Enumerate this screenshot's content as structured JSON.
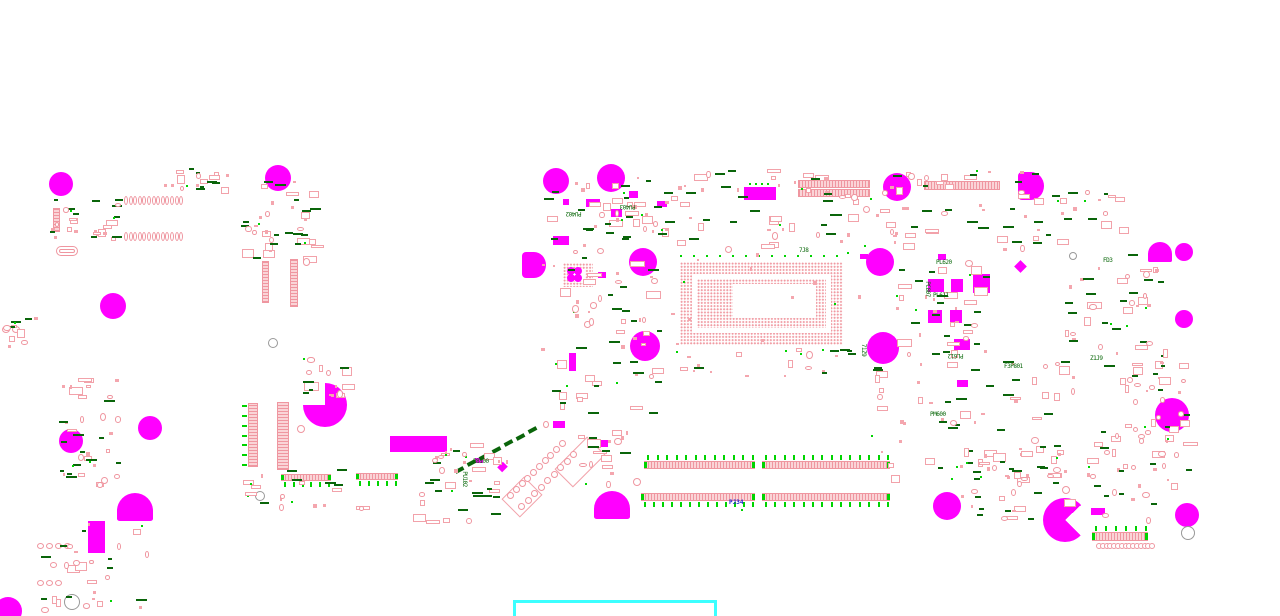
{
  "diagram": {
    "type": "pcb-component-placement-drawing",
    "board_size": [
      1280,
      616
    ],
    "colors": {
      "background": "#ffffff",
      "mounting_hole": "#ff00ff",
      "pad_outline": "#ef96a0",
      "pad_fill": "#fad4d7",
      "designator_green": "#076607",
      "tick_green": "#00d400",
      "designator_blue": "#2222cc",
      "selection_cyan": "#3cffff"
    },
    "labels": [
      [
        "PU402",
        566,
        210,
        180,
        "g"
      ],
      [
        "PU403",
        620,
        203,
        180,
        "g"
      ],
      [
        "PU102",
        456,
        476,
        90,
        "g"
      ],
      [
        "P8100",
        473,
        459,
        0,
        "g"
      ],
      [
        "PL611",
        933,
        293,
        0,
        "g"
      ],
      [
        "PC807",
        919,
        286,
        90,
        "g"
      ],
      [
        "PL612",
        948,
        352,
        180,
        "g"
      ],
      [
        "F3P801",
        1004,
        364,
        0,
        "g"
      ],
      [
        "PM600",
        930,
        412,
        0,
        "g"
      ],
      [
        "FD3",
        1103,
        258,
        0,
        "g"
      ],
      [
        "71Z9",
        857,
        347,
        90,
        "g"
      ],
      [
        "PL620",
        936,
        260,
        0,
        "g"
      ],
      [
        "7J8",
        799,
        248,
        0,
        "g"
      ],
      [
        "Z1J9",
        1090,
        356,
        0,
        "g"
      ],
      [
        "PJ34",
        729,
        500,
        0,
        "b"
      ]
    ],
    "holes": [
      [
        61,
        184,
        12,
        "c"
      ],
      [
        278,
        178,
        13,
        "c"
      ],
      [
        113,
        306,
        13,
        "c"
      ],
      [
        556,
        181,
        13,
        "c"
      ],
      [
        611,
        178,
        14,
        "c"
      ],
      [
        897,
        187,
        14,
        "c"
      ],
      [
        1030,
        186,
        14,
        "dl"
      ],
      [
        643,
        262,
        14,
        "c"
      ],
      [
        880,
        262,
        14,
        "c"
      ],
      [
        533,
        265,
        13,
        "dl"
      ],
      [
        1160,
        252,
        12,
        "db"
      ],
      [
        1184,
        252,
        9,
        "c"
      ],
      [
        1184,
        319,
        9,
        "c"
      ],
      [
        645,
        346,
        15,
        "c"
      ],
      [
        883,
        348,
        16,
        "c"
      ],
      [
        1172,
        415,
        17,
        "c"
      ],
      [
        150,
        428,
        12,
        "c"
      ],
      [
        71,
        441,
        12,
        "c"
      ],
      [
        325,
        405,
        22,
        "p1"
      ],
      [
        135,
        507,
        18,
        "db"
      ],
      [
        612,
        505,
        18,
        "db"
      ],
      [
        947,
        506,
        14,
        "c"
      ],
      [
        1187,
        515,
        12,
        "c"
      ],
      [
        1065,
        520,
        22,
        "p2"
      ],
      [
        8,
        611,
        14,
        "c"
      ]
    ],
    "solid_rects": [
      [
        390,
        436,
        57,
        16,
        0
      ],
      [
        88,
        521,
        17,
        32,
        0
      ],
      [
        744,
        187,
        32,
        13,
        0
      ],
      [
        563,
        199,
        6,
        6,
        0
      ],
      [
        586,
        199,
        14,
        8,
        0
      ],
      [
        611,
        209,
        11,
        8,
        0
      ],
      [
        629,
        191,
        9,
        7,
        0
      ],
      [
        657,
        201,
        10,
        6,
        0
      ],
      [
        553,
        236,
        16,
        9,
        0
      ],
      [
        598,
        272,
        8,
        6,
        0
      ],
      [
        569,
        353,
        7,
        18,
        0
      ],
      [
        938,
        254,
        8,
        6,
        0
      ],
      [
        928,
        279,
        16,
        13,
        0
      ],
      [
        951,
        279,
        12,
        13,
        0
      ],
      [
        928,
        310,
        14,
        13,
        0
      ],
      [
        950,
        310,
        12,
        13,
        0
      ],
      [
        973,
        274,
        17,
        19,
        0
      ],
      [
        954,
        339,
        16,
        11,
        0
      ],
      [
        957,
        380,
        11,
        7,
        0
      ],
      [
        1016,
        262,
        9,
        9,
        45
      ],
      [
        1091,
        508,
        14,
        7,
        0
      ],
      [
        860,
        254,
        8,
        5,
        0
      ],
      [
        475,
        458,
        8,
        5,
        0
      ],
      [
        499,
        463,
        7,
        8,
        45
      ],
      [
        601,
        440,
        7,
        7,
        0
      ],
      [
        553,
        421,
        12,
        7,
        0
      ]
    ],
    "green_dots": [
      [
        749,
        183
      ],
      [
        755,
        183
      ],
      [
        761,
        183
      ],
      [
        767,
        183
      ],
      [
        741,
        509
      ],
      [
        247,
        495
      ]
    ],
    "connectors": [
      [
        644,
        461,
        111,
        8,
        "h",
        "a"
      ],
      [
        762,
        461,
        128,
        8,
        "h",
        "a"
      ],
      [
        641,
        493,
        114,
        8,
        "h",
        "b"
      ],
      [
        762,
        493,
        128,
        8,
        "h",
        "b"
      ],
      [
        924,
        181,
        76,
        9,
        "h",
        ""
      ],
      [
        798,
        180,
        72,
        8,
        "h",
        ""
      ],
      [
        798,
        189,
        72,
        8,
        "h",
        ""
      ],
      [
        281,
        474,
        50,
        7,
        "h",
        "b"
      ],
      [
        356,
        473,
        42,
        7,
        "h",
        "b"
      ],
      [
        1092,
        532,
        56,
        9,
        "h",
        "a"
      ],
      [
        262,
        261,
        7,
        42,
        "v",
        ""
      ],
      [
        290,
        259,
        8,
        48,
        "v",
        ""
      ],
      [
        248,
        403,
        10,
        64,
        "v",
        "l"
      ],
      [
        277,
        402,
        12,
        68,
        "v",
        ""
      ],
      [
        53,
        208,
        7,
        24,
        "v",
        ""
      ]
    ],
    "oval_rows": [
      [
        124,
        196,
        13,
        4.6,
        4,
        9
      ],
      [
        124,
        232,
        13,
        4.6,
        4,
        9
      ],
      [
        37,
        543,
        4,
        9,
        7,
        6
      ],
      [
        37,
        580,
        3,
        9,
        7,
        6
      ],
      [
        2,
        326,
        2,
        10,
        8,
        7
      ]
    ],
    "circ_rows": [
      [
        1096,
        543,
        15,
        3.8,
        6
      ]
    ],
    "rings": [
      [
        1073,
        256,
        4,
        "g"
      ],
      [
        1188,
        533,
        7,
        "g"
      ],
      [
        72,
        602,
        8,
        "g"
      ],
      [
        273,
        343,
        5,
        "g"
      ],
      [
        260,
        496,
        5,
        "g"
      ],
      [
        301,
        429,
        4,
        "p"
      ],
      [
        637,
        482,
        4,
        "p"
      ]
    ],
    "stadiums": [
      [
        56,
        246,
        22,
        10
      ]
    ],
    "cpu_bga": {
      "x": 680,
      "y": 262,
      "w": 163,
      "h": 83,
      "band": 12,
      "inner_pad": 17,
      "die": [
        733,
        284,
        83,
        34
      ],
      "perim_dot_step": 13
    },
    "qfn": {
      "x": 563,
      "y": 263,
      "w": 30,
      "h": 24,
      "center": [
        571,
        269,
        14,
        12
      ],
      "blobs": [
        [
          571,
          271
        ],
        [
          578,
          271
        ],
        [
          571,
          278
        ],
        [
          578,
          278
        ]
      ]
    },
    "diag_group": {
      "outlines": [
        [
          580,
          462,
          46,
          26
        ],
        [
          522,
          497,
          32,
          26
        ]
      ],
      "ring_lines": [
        [
          510,
          495,
          562,
          443,
          10
        ],
        [
          521,
          506,
          573,
          454,
          9
        ]
      ],
      "green_line": [
        455,
        468,
        528,
        428,
        7
      ]
    },
    "selection_box": [
      513,
      600,
      204,
      30
    ],
    "clusters": [
      [
        50,
        198,
        70,
        42,
        6,
        8,
        10,
        2,
        3,
        1
      ],
      [
        160,
        168,
        70,
        20,
        4,
        6,
        6,
        1,
        2,
        2
      ],
      [
        238,
        178,
        75,
        85,
        8,
        12,
        14,
        2,
        6,
        3
      ],
      [
        300,
        352,
        45,
        42,
        3,
        5,
        5,
        1,
        4,
        4
      ],
      [
        58,
        375,
        60,
        110,
        8,
        10,
        12,
        2,
        8,
        5
      ],
      [
        35,
        520,
        110,
        90,
        5,
        7,
        8,
        2,
        10,
        6
      ],
      [
        408,
        440,
        100,
        80,
        8,
        12,
        12,
        3,
        6,
        7
      ],
      [
        540,
        175,
        140,
        75,
        12,
        16,
        18,
        4,
        6,
        8
      ],
      [
        540,
        255,
        120,
        170,
        12,
        18,
        20,
        4,
        10,
        9
      ],
      [
        680,
        168,
        180,
        85,
        12,
        16,
        16,
        3,
        6,
        10
      ],
      [
        862,
        168,
        200,
        80,
        14,
        18,
        18,
        4,
        8,
        11
      ],
      [
        862,
        360,
        200,
        120,
        14,
        20,
        20,
        3,
        8,
        12
      ],
      [
        1062,
        250,
        100,
        140,
        10,
        14,
        16,
        3,
        10,
        13
      ],
      [
        955,
        440,
        110,
        80,
        10,
        14,
        14,
        3,
        6,
        14
      ],
      [
        1085,
        420,
        90,
        110,
        6,
        10,
        8,
        2,
        10,
        15
      ],
      [
        660,
        345,
        200,
        40,
        6,
        4,
        6,
        2,
        2,
        16
      ],
      [
        1130,
        330,
        60,
        140,
        4,
        6,
        6,
        1,
        12,
        17
      ],
      [
        895,
        255,
        90,
        100,
        8,
        12,
        14,
        3,
        4,
        18
      ],
      [
        575,
        428,
        60,
        60,
        4,
        6,
        4,
        1,
        4,
        19
      ],
      [
        240,
        468,
        120,
        40,
        4,
        6,
        6,
        2,
        3,
        20
      ],
      [
        0,
        316,
        36,
        32,
        2,
        3,
        3,
        1,
        2,
        21
      ],
      [
        1060,
        190,
        60,
        40,
        3,
        5,
        4,
        1,
        2,
        22
      ],
      [
        655,
        252,
        215,
        115,
        12,
        0,
        0,
        4,
        0,
        24
      ]
    ]
  }
}
